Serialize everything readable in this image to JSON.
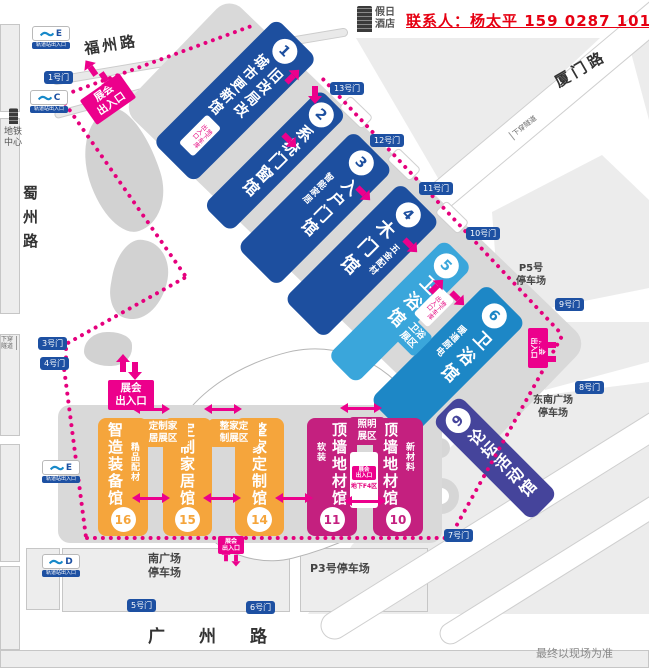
{
  "contact": "联系人：杨太平 159 0287 1013",
  "hotel": "假日\n酒店",
  "disclaimer": "最终以现场为准",
  "roads": {
    "fuzhou": "福州路",
    "xiamen": "厦门路",
    "shuzhou": "蜀州路",
    "guangzhou": "广州路",
    "underpass": "下穿隧道",
    "metro_center": "地铁\n中心"
  },
  "metro": {
    "caption": "轨道站出入口",
    "exits": [
      "E",
      "C",
      "E",
      "D"
    ]
  },
  "gates": {
    "g1": "1号门",
    "g3": "3号门",
    "g4": "4号门",
    "g5": "5号门",
    "g6": "6号门",
    "g7": "7号门",
    "g8": "8号门",
    "g9": "9号门",
    "g10": "10号门",
    "g11": "11号门",
    "g12": "12号门",
    "g13": "13号门"
  },
  "parking": {
    "p5": "P5号\n停车场",
    "p3": "P3号停车场",
    "south": "南广场\n停车场",
    "southeast": "东南广场\n停车场"
  },
  "entrance": {
    "label": "展会\n出入口",
    "basement": "地下车库\n出入口",
    "f4": "地下F4区"
  },
  "halls": {
    "h1": {
      "num": "1",
      "name": "旧改局改\n城市更新馆"
    },
    "h2": {
      "num": "2",
      "name": "系统门窗馆"
    },
    "h3": {
      "num": "3",
      "name": "入户门馆",
      "sub": "智能家居"
    },
    "h4": {
      "num": "4",
      "name": "木门馆",
      "sub": "五金配材"
    },
    "h5": {
      "num": "5",
      "name": "卫浴馆"
    },
    "h6": {
      "num": "6",
      "name": "卫浴馆",
      "sub": "暖通厨电"
    },
    "h9": {
      "num": "9",
      "name": "论坛活动馆"
    },
    "h10": {
      "num": "10",
      "name": "顶墙地材馆",
      "sub": "新材料"
    },
    "h11": {
      "num": "11",
      "name": "顶墙地材馆",
      "sub": "软装"
    },
    "h14": {
      "num": "14",
      "name": "整家定制馆"
    },
    "h15": {
      "num": "15",
      "name": "定制家居馆"
    },
    "h16": {
      "num": "16",
      "name": "智造装备馆",
      "sub": "精品配材"
    }
  },
  "zones": {
    "custom_home": "定制家\n居展区",
    "whole_home": "整家定\n制展区",
    "lighting": "照明\n展区",
    "bath": "卫浴\n展区"
  },
  "colors": {
    "dark_blue": "#1d4f9f",
    "light_blue": "#3aa6db",
    "mid_blue": "#1d87c6",
    "indigo": "#45449b",
    "pink_hall": "#c4207f",
    "hot_pink": "#ec008c",
    "dotted_pink": "#e5007d",
    "orange": "#f5a53c",
    "gate_blue": "#1d50a2",
    "contact_red": "#e60012"
  }
}
